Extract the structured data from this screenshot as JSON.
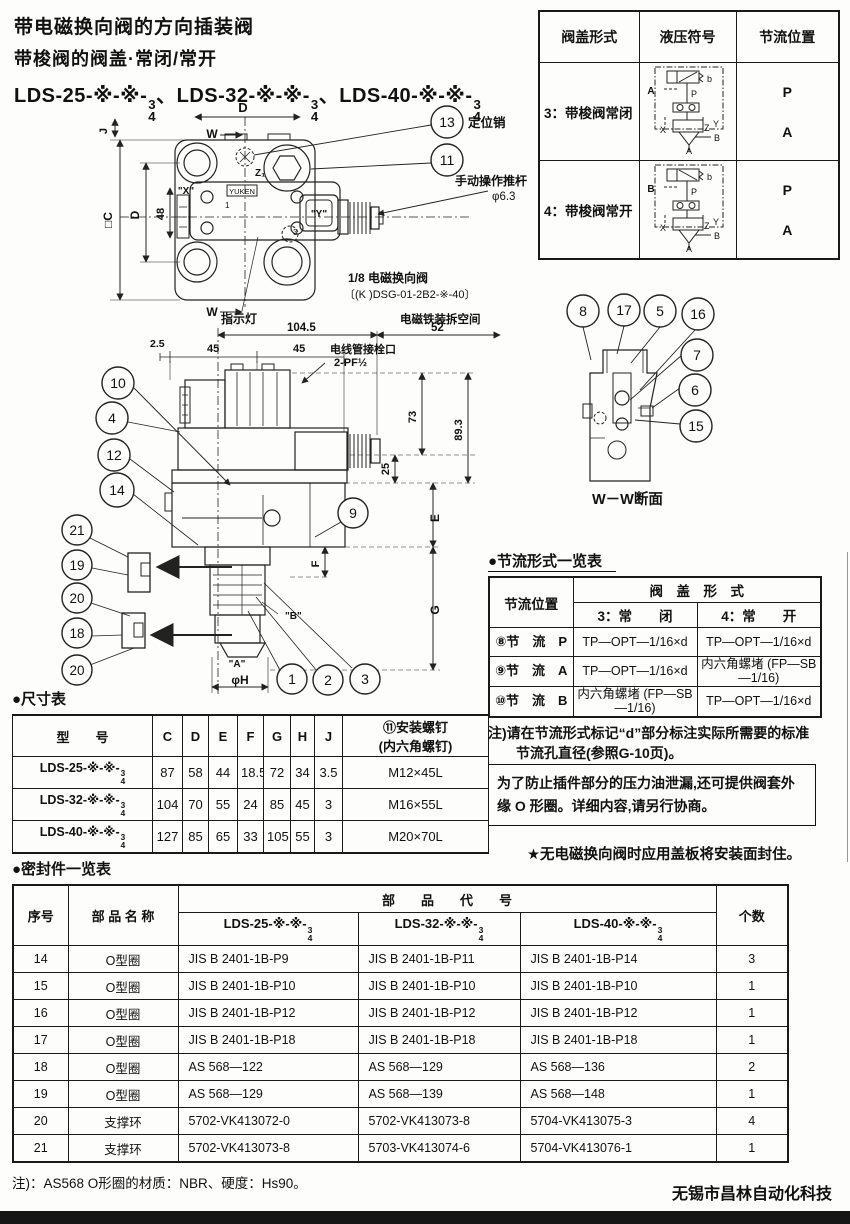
{
  "header": {
    "title_line1": "带电磁换向阀的方向插装阀",
    "title_line2": "带梭阀的阀盖·常闭/常开",
    "model_separator": "、",
    "models": [
      {
        "prefix": "LDS-25-※-※-",
        "num": "3",
        "den": "4"
      },
      {
        "prefix": "LDS-32-※-※-",
        "num": "3",
        "den": "4"
      },
      {
        "prefix": "LDS-40-※-※-",
        "num": "3",
        "den": "4"
      }
    ]
  },
  "cover_table": {
    "col_headers": [
      "阀盖形式",
      "液压符号",
      "节流位置"
    ],
    "rows": [
      {
        "form": "3：带梭阀常闭",
        "positions": [
          "P",
          "A"
        ],
        "sym": {
          "left": "A",
          "b": "b",
          "p": "P",
          "x": "X",
          "z": "Z",
          "y": "Y",
          "side": "B",
          "bottom": "A"
        }
      },
      {
        "form": "4：带梭阀常开",
        "positions": [
          "P",
          "A"
        ],
        "sym": {
          "left": "B",
          "b": "b",
          "p": "P",
          "x": "X",
          "z": "Z",
          "y": "Y",
          "side": "B",
          "bottom": "A"
        }
      }
    ]
  },
  "plan_view": {
    "balloon_13": "13",
    "balloon_11": "11",
    "label_pin": "定位销",
    "label_rod_1": "手动操作推杆",
    "label_rod_2": "φ6.3",
    "dim_d_top": "D",
    "dim_w_top": "W",
    "dim_w_bottom": "W",
    "dim_j": "J",
    "dim_c": "□C",
    "dim_d_left": "D",
    "dim_48": "48",
    "port_x": "\"X\"",
    "port_y": "\"Y\"",
    "port_z": "Z₁",
    "mark_1": "1",
    "mark_3": "3",
    "brand": "YUKEN",
    "label_indicator": "指示灯",
    "label_sol_1": "1/8 电磁换向阀",
    "label_sol_2": "〔(K )DSG-01-2B2-※-40〕"
  },
  "side_view": {
    "label_space": "电磁铁装拆空间",
    "dim_104_5": "104.5",
    "dim_52": "52",
    "dim_2_5": "2.5",
    "dim_45a": "45",
    "dim_45b": "45",
    "label_conduit_1": "电线管接栓口",
    "label_conduit_2": "2-PF½",
    "dim_73": "73",
    "dim_89_3": "89.3",
    "dim_25": "25",
    "dim_e": "E",
    "dim_f": "F",
    "dim_g": "G",
    "dim_phi_h": "φH",
    "port_a": "\"A\"",
    "port_b": "\"B\"",
    "balloons_upper": [
      "10",
      "4",
      "12",
      "14"
    ],
    "balloons_lower": [
      "21",
      "19",
      "20",
      "18",
      "20"
    ],
    "balloon_9": "9",
    "balloons_bottom": [
      "1",
      "2",
      "3"
    ]
  },
  "section_view": {
    "balloons_top": [
      "8",
      "17",
      "5",
      "16"
    ],
    "balloons_right": [
      "7",
      "6",
      "15"
    ],
    "caption": "W－W断面"
  },
  "throttle_table": {
    "title": "●节流形式一览表",
    "col1_header": "节流位置",
    "span_header": "阀　盖　形　式",
    "sub_headers": [
      "3：常　　闭",
      "4：常　　开"
    ],
    "rows": [
      {
        "pos": "⑧节　流　P",
        "closed": "TP—OPT—1/16×d",
        "open": "TP—OPT—1/16×d"
      },
      {
        "pos": "⑨节　流　A",
        "closed": "TP—OPT—1/16×d",
        "open": "内六角螺堵 (FP—SB—1/16)"
      },
      {
        "pos": "⑩节　流　B",
        "closed": "内六角螺堵 (FP—SB—1/16)",
        "open": "TP—OPT—1/16×d"
      }
    ],
    "note_1": "注)请在节流形式标记“d”部分标注实际所需要的标准",
    "note_2": "节流孔直径(参照G-10页)。"
  },
  "notices": {
    "box_note": "为了防止插件部分的压力油泄漏,还可提供阀套外缘 O 形圈。详细内容,请另行协商。",
    "star_note": "★无电磁换向阀时应用盖板将安装面封住。"
  },
  "dimension_table": {
    "title": "●尺寸表",
    "model_header": "型　　号",
    "dim_headers": [
      "C",
      "D",
      "E",
      "F",
      "G",
      "H",
      "J"
    ],
    "screw_header_1": "⑪安装螺钉",
    "screw_header_2": "(内六角螺钉)",
    "rows": [
      {
        "prefix": "LDS-25-※-※-",
        "num": "3",
        "den": "4",
        "c": "87",
        "d": "58",
        "e": "44",
        "f": "18.5",
        "g": "72",
        "h": "34",
        "j": "3.5",
        "screw": "M12×45L"
      },
      {
        "prefix": "LDS-32-※-※-",
        "num": "3",
        "den": "4",
        "c": "104",
        "d": "70",
        "e": "55",
        "f": "24",
        "g": "85",
        "h": "45",
        "j": "3",
        "screw": "M16×55L"
      },
      {
        "prefix": "LDS-40-※-※-",
        "num": "3",
        "den": "4",
        "c": "127",
        "d": "85",
        "e": "65",
        "f": "33",
        "g": "105",
        "h": "55",
        "j": "3",
        "screw": "M20×70L"
      }
    ]
  },
  "seal_table": {
    "title": "●密封件一览表",
    "col_no": "序号",
    "col_name": "部 品 名 称",
    "col_code": "部　　品　　代　　号",
    "col_qty": "个数",
    "models": [
      {
        "prefix": "LDS-25-※-※-",
        "num": "3",
        "den": "4"
      },
      {
        "prefix": "LDS-32-※-※-",
        "num": "3",
        "den": "4"
      },
      {
        "prefix": "LDS-40-※-※-",
        "num": "3",
        "den": "4"
      }
    ],
    "rows": [
      {
        "no": "14",
        "name": "O型圈",
        "c25": "JIS B 2401-1B-P9",
        "c32": "JIS B 2401-1B-P11",
        "c40": "JIS B 2401-1B-P14",
        "qty": "3"
      },
      {
        "no": "15",
        "name": "O型圈",
        "c25": "JIS B 2401-1B-P10",
        "c32": "JIS B 2401-1B-P10",
        "c40": "JIS B 2401-1B-P10",
        "qty": "1"
      },
      {
        "no": "16",
        "name": "O型圈",
        "c25": "JIS B 2401-1B-P12",
        "c32": "JIS B 2401-1B-P12",
        "c40": "JIS B 2401-1B-P12",
        "qty": "1"
      },
      {
        "no": "17",
        "name": "O型圈",
        "c25": "JIS B 2401-1B-P18",
        "c32": "JIS B 2401-1B-P18",
        "c40": "JIS B 2401-1B-P18",
        "qty": "1"
      },
      {
        "no": "18",
        "name": "O型圈",
        "c25": "AS 568—122",
        "c32": "AS 568—129",
        "c40": "AS 568—136",
        "qty": "2"
      },
      {
        "no": "19",
        "name": "O型圈",
        "c25": "AS 568—129",
        "c32": "AS 568—139",
        "c40": "AS 568—148",
        "qty": "1"
      },
      {
        "no": "20",
        "name": "支撑环",
        "c25": "5702-VK413072-0",
        "c32": "5702-VK413073-8",
        "c40": "5704-VK413075-3",
        "qty": "4"
      },
      {
        "no": "21",
        "name": "支撑环",
        "c25": "5702-VK413073-8",
        "c32": "5703-VK413074-6",
        "c40": "5704-VK413076-1",
        "qty": "1"
      }
    ],
    "note": "注)：AS568 O形圈的材质：NBR、硬度：Hs90。"
  },
  "footer": {
    "company": "无锡市昌林自动化科技"
  }
}
